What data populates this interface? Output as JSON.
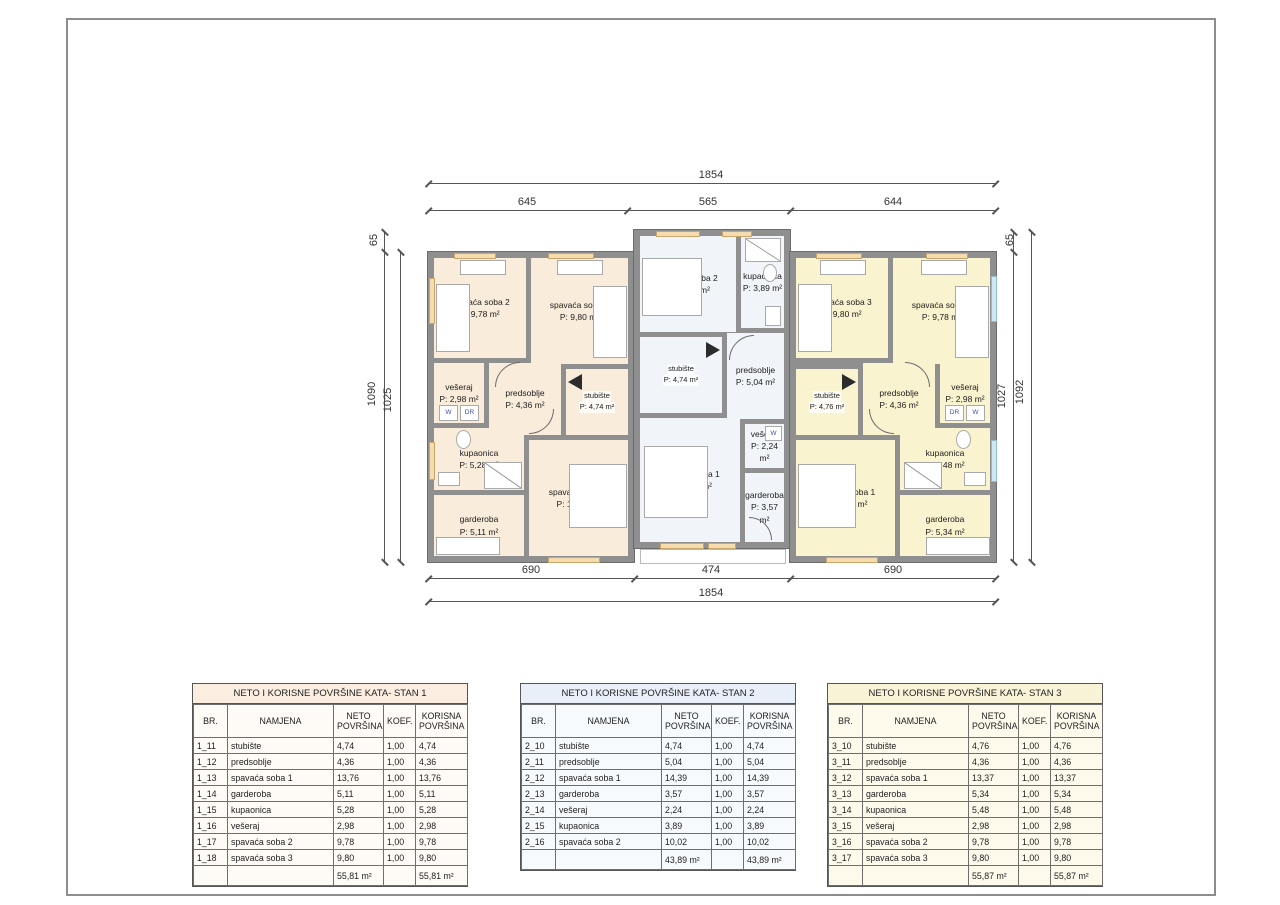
{
  "plan": {
    "appliance_labels": {
      "washer": "W",
      "dryer": "DR"
    },
    "colors": {
      "stan1_fill": "#f9ecdb",
      "stan2_fill": "#f1f4f9",
      "stan3_fill": "#faf3cf",
      "wall": "#8f8f8f",
      "window_sill": "#f4dcae",
      "glazing": "#cfe8f0"
    },
    "units": [
      {
        "id": "stan1",
        "rooms": [
          {
            "name": "spavaća soba 2",
            "area": "P: 9,78 m²"
          },
          {
            "name": "spavaća soba 3",
            "area": "P: 9,80 m²"
          },
          {
            "name": "vešeraj",
            "area": "P: 2,98 m²"
          },
          {
            "name": "predsoblje",
            "area": "P: 4,36 m²"
          },
          {
            "name": "stubište",
            "area": "P: 4,74 m²"
          },
          {
            "name": "kupaonica",
            "area": "P: 5,28 m²"
          },
          {
            "name": "garderoba",
            "area": "P: 5,11 m²"
          },
          {
            "name": "spavaća soba 1",
            "area": "P: 13,76 m²"
          }
        ]
      },
      {
        "id": "stan2",
        "rooms": [
          {
            "name": "spavaća soba 2",
            "area": "P: 10,02 m²"
          },
          {
            "name": "kupaonica",
            "area": "P: 3,89 m²"
          },
          {
            "name": "stubište",
            "area": "P: 4,74 m²"
          },
          {
            "name": "predsoblje",
            "area": "P: 5,04 m²"
          },
          {
            "name": "spavaća soba 1",
            "area": "P: 14,39 m²"
          },
          {
            "name": "vešeraj",
            "area": "P: 2,24 m²"
          },
          {
            "name": "garderoba",
            "area": "P: 3,57 m²"
          }
        ]
      },
      {
        "id": "stan3",
        "rooms": [
          {
            "name": "spavaća soba 3",
            "area": "P: 9,80 m²"
          },
          {
            "name": "spavaća soba 2",
            "area": "P: 9,78 m²"
          },
          {
            "name": "stubište",
            "area": "P: 4,76 m²"
          },
          {
            "name": "predsoblje",
            "area": "P: 4,36 m²"
          },
          {
            "name": "vešeraj",
            "area": "P: 2,98 m²"
          },
          {
            "name": "spavaća soba 1",
            "area": "P: 13,37 m²"
          },
          {
            "name": "kupaonica",
            "area": "P: 5,48 m²"
          },
          {
            "name": "garderoba",
            "area": "P: 5,34 m²"
          }
        ]
      }
    ]
  },
  "dims": {
    "top_total": "1854",
    "top_segments": [
      "645",
      "565",
      "644"
    ],
    "bottom_segments": [
      "690",
      "474",
      "690"
    ],
    "bottom_total": "1854",
    "left": {
      "offset": "65",
      "outer": "1090",
      "inner": "1025"
    },
    "right": {
      "offset": "65",
      "inner": "1027",
      "outer": "1092"
    }
  },
  "table_headers": [
    "BR.",
    "NAMJENA",
    "NETO POVRŠINA",
    "KOEF.",
    "KORISNA POVRŠINA"
  ],
  "tables": [
    {
      "title": "NETO I KORISNE POVRŠINE KATA- STAN 1",
      "rows": [
        [
          "1_11",
          "stubište",
          "4,74",
          "1,00",
          "4,74"
        ],
        [
          "1_12",
          "predsoblje",
          "4,36",
          "1,00",
          "4,36"
        ],
        [
          "1_13",
          "spavaća soba 1",
          "13,76",
          "1,00",
          "13,76"
        ],
        [
          "1_14",
          "garderoba",
          "5,11",
          "1,00",
          "5,11"
        ],
        [
          "1_15",
          "kupaonica",
          "5,28",
          "1,00",
          "5,28"
        ],
        [
          "1_16",
          "vešeraj",
          "2,98",
          "1,00",
          "2,98"
        ],
        [
          "1_17",
          "spavaća soba 2",
          "9,78",
          "1,00",
          "9,78"
        ],
        [
          "1_18",
          "spavaća soba 3",
          "9,80",
          "1,00",
          "9,80"
        ],
        [
          "",
          "",
          "55,81 m²",
          "",
          "55,81 m²"
        ]
      ]
    },
    {
      "title": "NETO I KORISNE POVRŠINE KATA- STAN 2",
      "rows": [
        [
          "2_10",
          "stubište",
          "4,74",
          "1,00",
          "4,74"
        ],
        [
          "2_11",
          "predsoblje",
          "5,04",
          "1,00",
          "5,04"
        ],
        [
          "2_12",
          "spavaća soba 1",
          "14,39",
          "1,00",
          "14,39"
        ],
        [
          "2_13",
          "garderoba",
          "3,57",
          "1,00",
          "3,57"
        ],
        [
          "2_14",
          "vešeraj",
          "2,24",
          "1,00",
          "2,24"
        ],
        [
          "2_15",
          "kupaonica",
          "3,89",
          "1,00",
          "3,89"
        ],
        [
          "2_16",
          "spavaća soba 2",
          "10,02",
          "1,00",
          "10,02"
        ],
        [
          "",
          "",
          "43,89 m²",
          "",
          "43,89 m²"
        ]
      ]
    },
    {
      "title": "NETO I KORISNE POVRŠINE KATA- STAN 3",
      "rows": [
        [
          "3_10",
          "stubište",
          "4,76",
          "1,00",
          "4,76"
        ],
        [
          "3_11",
          "predsoblje",
          "4,36",
          "1,00",
          "4,36"
        ],
        [
          "3_12",
          "spavaća soba 1",
          "13,37",
          "1,00",
          "13,37"
        ],
        [
          "3_13",
          "garderoba",
          "5,34",
          "1,00",
          "5,34"
        ],
        [
          "3_14",
          "kupaonica",
          "5,48",
          "1,00",
          "5,48"
        ],
        [
          "3_15",
          "vešeraj",
          "2,98",
          "1,00",
          "2,98"
        ],
        [
          "3_16",
          "spavaća soba 2",
          "9,78",
          "1,00",
          "9,78"
        ],
        [
          "3_17",
          "spavaća soba 3",
          "9,80",
          "1,00",
          "9,80"
        ],
        [
          "",
          "",
          "55,87 m²",
          "",
          "55,87 m²"
        ]
      ]
    }
  ]
}
